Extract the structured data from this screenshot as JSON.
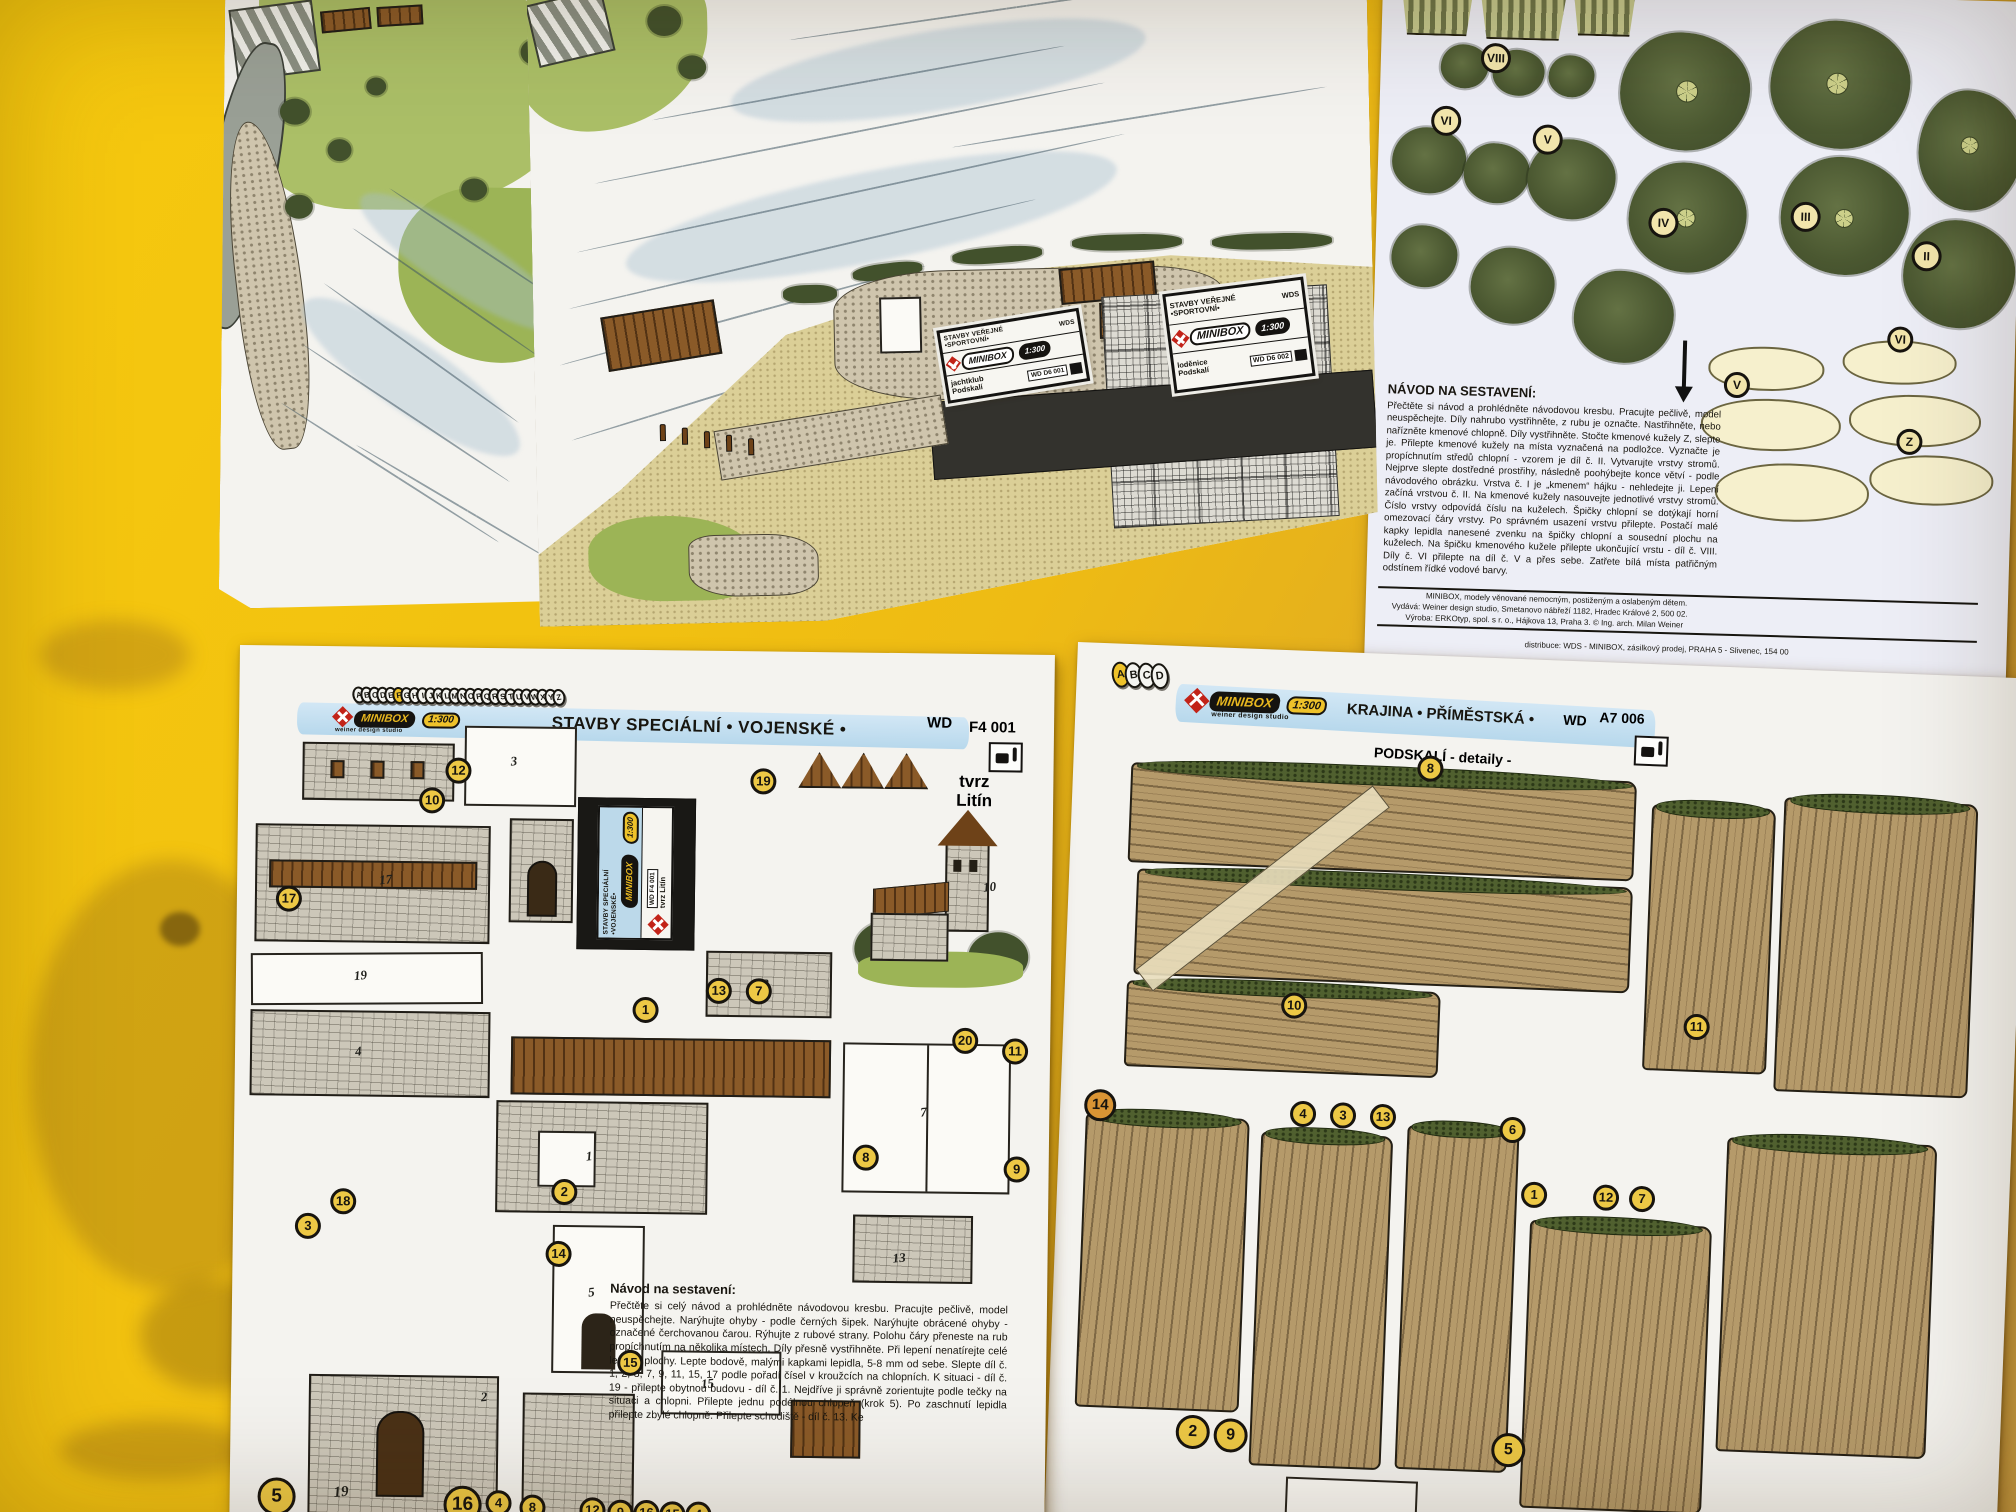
{
  "colors": {
    "table_yellow": "#f0c010",
    "banner_blue": "#bcdcf0",
    "badge_yellow": "#edc845",
    "badge_orange": "#d99434",
    "logo_red": "#c22318",
    "logo_gold": "#e8b71f",
    "paper": "#f4f3ef"
  },
  "marina_sheet": {
    "label_yacht_club": {
      "line1": "STAVBY VEŘEJNÉ",
      "line2": "•SPORTOVNÍ•",
      "wds": "WDS",
      "brand": "MINIBOX",
      "scale": "1:300",
      "name1": "jachtklub",
      "name2": "Podskalí",
      "code": "WD D6 001"
    },
    "label_boathouse": {
      "line1": "STAVBY VEŘEJNÉ",
      "line2": "•SPORTOVNÍ•",
      "wds": "WDS",
      "brand": "MINIBOX",
      "scale": "1:300",
      "name1": "loděnice",
      "name2": "Podskalí",
      "code": "WD D6 002"
    }
  },
  "trees_sheet": {
    "roman_badges": [
      "VIII",
      "VI",
      "V",
      "IV",
      "III",
      "II"
    ],
    "diagram_badges": [
      "V",
      "VI",
      "Z"
    ],
    "instructions_title": "NÁVOD NA SESTAVENÍ:",
    "instructions_body": "Přečtěte si návod a prohlédněte návodovou kresbu. Pracujte pečlivě, model neuspěchejte. Díly nahrubo vystřihněte, z rubu je označte. Nastřihněte, nebo nařízněte kmenové chlopně. Díly vystřihněte. Stočte kmenové kužely Z, slepte je. Přilepte kmenové kužely na místa vyznačená na podložce. Vyznačte je propíchnutím středů chlopní - vzorem je díl č. II. Vytvarujte vrstvy stromů. Nejprve slepte dostředné prostřihy, následně poohýbejte konce větví - podle návodového obrázku. Vrstva č. I je „kmenem“ hájku - nehledejte ji. Lepení začíná vrstvou č. II. Na kmenové kužely nasouvejte jednotlivé vrstvy stromů. Číslo vrstvy odpovídá číslu na kuželech. Špičky chlopní se dotýkají horní omezovací čáry vrstvy. Po správném usazení vrstvu přilepte. Postačí malé kapky lepidla nanesené zvenku na špičky chlopní a sousední plochu na kuželech. Na špičku kmenového kužele přilepte ukončující vrstu - díl č. VIII. Díly č. VI přilepte na díl č. V a přes sebe. Zatřete bílá místa patřičným odstínem řídké vodové barvy.",
    "footer_line1": "MINIBOX, modely věnované nemocným, postiženým a oslabeným dětem.",
    "footer_line2": "Vydává: Weiner design studio, Smetanovo nábřeží 1182, Hradec Králové 2, 500 02.",
    "footer_line3": "Výroba: ERKOtyp, spol. s r. o., Hájkova 13, Praha 3. © Ing. arch. Milan Weiner",
    "footer_distribution": "distribuce: WDS - MINIBOX, zásilkový prodej, PRAHA 5 - Slivenec, 154 00"
  },
  "castle_sheet": {
    "alphabet": "ABCDEFGHIJKLMNOPQRSTUVWXYZ",
    "brand": "MINIBOX",
    "scale": "1:300",
    "studio": "weiner design studio",
    "wds": "WDS",
    "banner": "STAVBY SPECIÁLNÍ • VOJENSKÉ •",
    "wd": "WD",
    "code": "F4 001",
    "subject_line1": "tvrz",
    "subject_line2": "Litín",
    "side_label": {
      "line1": "STAVBY SPECIÁLNÍ",
      "line2": "•VOJENSKÉ•",
      "brand": "MINIBOX",
      "scale": "1:300",
      "code": "WD F4 001",
      "subject": "tvrz Litín"
    },
    "badges": [
      "12",
      "10",
      "19",
      "17",
      "1",
      "13",
      "7",
      "20",
      "11",
      "8",
      "9",
      "2",
      "18",
      "3",
      "14",
      "15"
    ],
    "bottom_badges": [
      "5",
      "16",
      "4",
      "8",
      "12",
      "9",
      "16",
      "15",
      "4"
    ],
    "bottom_part_label": "19",
    "part_numbers": [
      "3",
      "19",
      "4",
      "17",
      "7",
      "2",
      "5",
      "12",
      "15",
      "1",
      "10",
      "13"
    ],
    "instructions_title": "Návod na sestavení:",
    "instructions_body": "Přečtěte si celý návod a prohlédněte návodovou kresbu. Pracujte pečlivě, model neuspěchejte. Narýhujte ohyby - podle černých šipek. Narýhujte obrácené ohyby - označené čerchovanou čarou. Rýhujte z rubové strany. Polohu čáry přeneste na rub propíchnutím na několika místech. Díly přesně vystřihněte. Při lepení nenatírejte celé lepené plochy. Lepte bodově, malými kapkami lepidla, 5-8 mm od sebe. Slepte díl č. 1, 2, 3, 7, 9, 11, 15, 17 podle pořadí čísel v kroužcích na chlopních. K situaci - díl č. 19 - přilepte obytnou budovu - díl č. 1. Nejdříve ji správně zorientujte podle tečky na situaci a chlopni. Přilepte jednu podélnou chlopeň (krok 5). Po zaschnutí lepidla přilepte zbylé chlopně. Přilepte schodiště - díl č. 13. Ke"
  },
  "rocks_sheet": {
    "alphabet": "ABCD",
    "brand": "MINIBOX",
    "scale": "1:300",
    "studio": "weiner design studio",
    "banner": "KRAJINA • PŘÍMĚSTSKÁ •",
    "wd": "WD",
    "code": "A7 006",
    "subject": "PODSKALÍ - detaily -",
    "badges": [
      "8",
      "10",
      "11",
      "14",
      "4",
      "3",
      "13",
      "6",
      "1",
      "12",
      "7",
      "2",
      "9",
      "5"
    ]
  }
}
